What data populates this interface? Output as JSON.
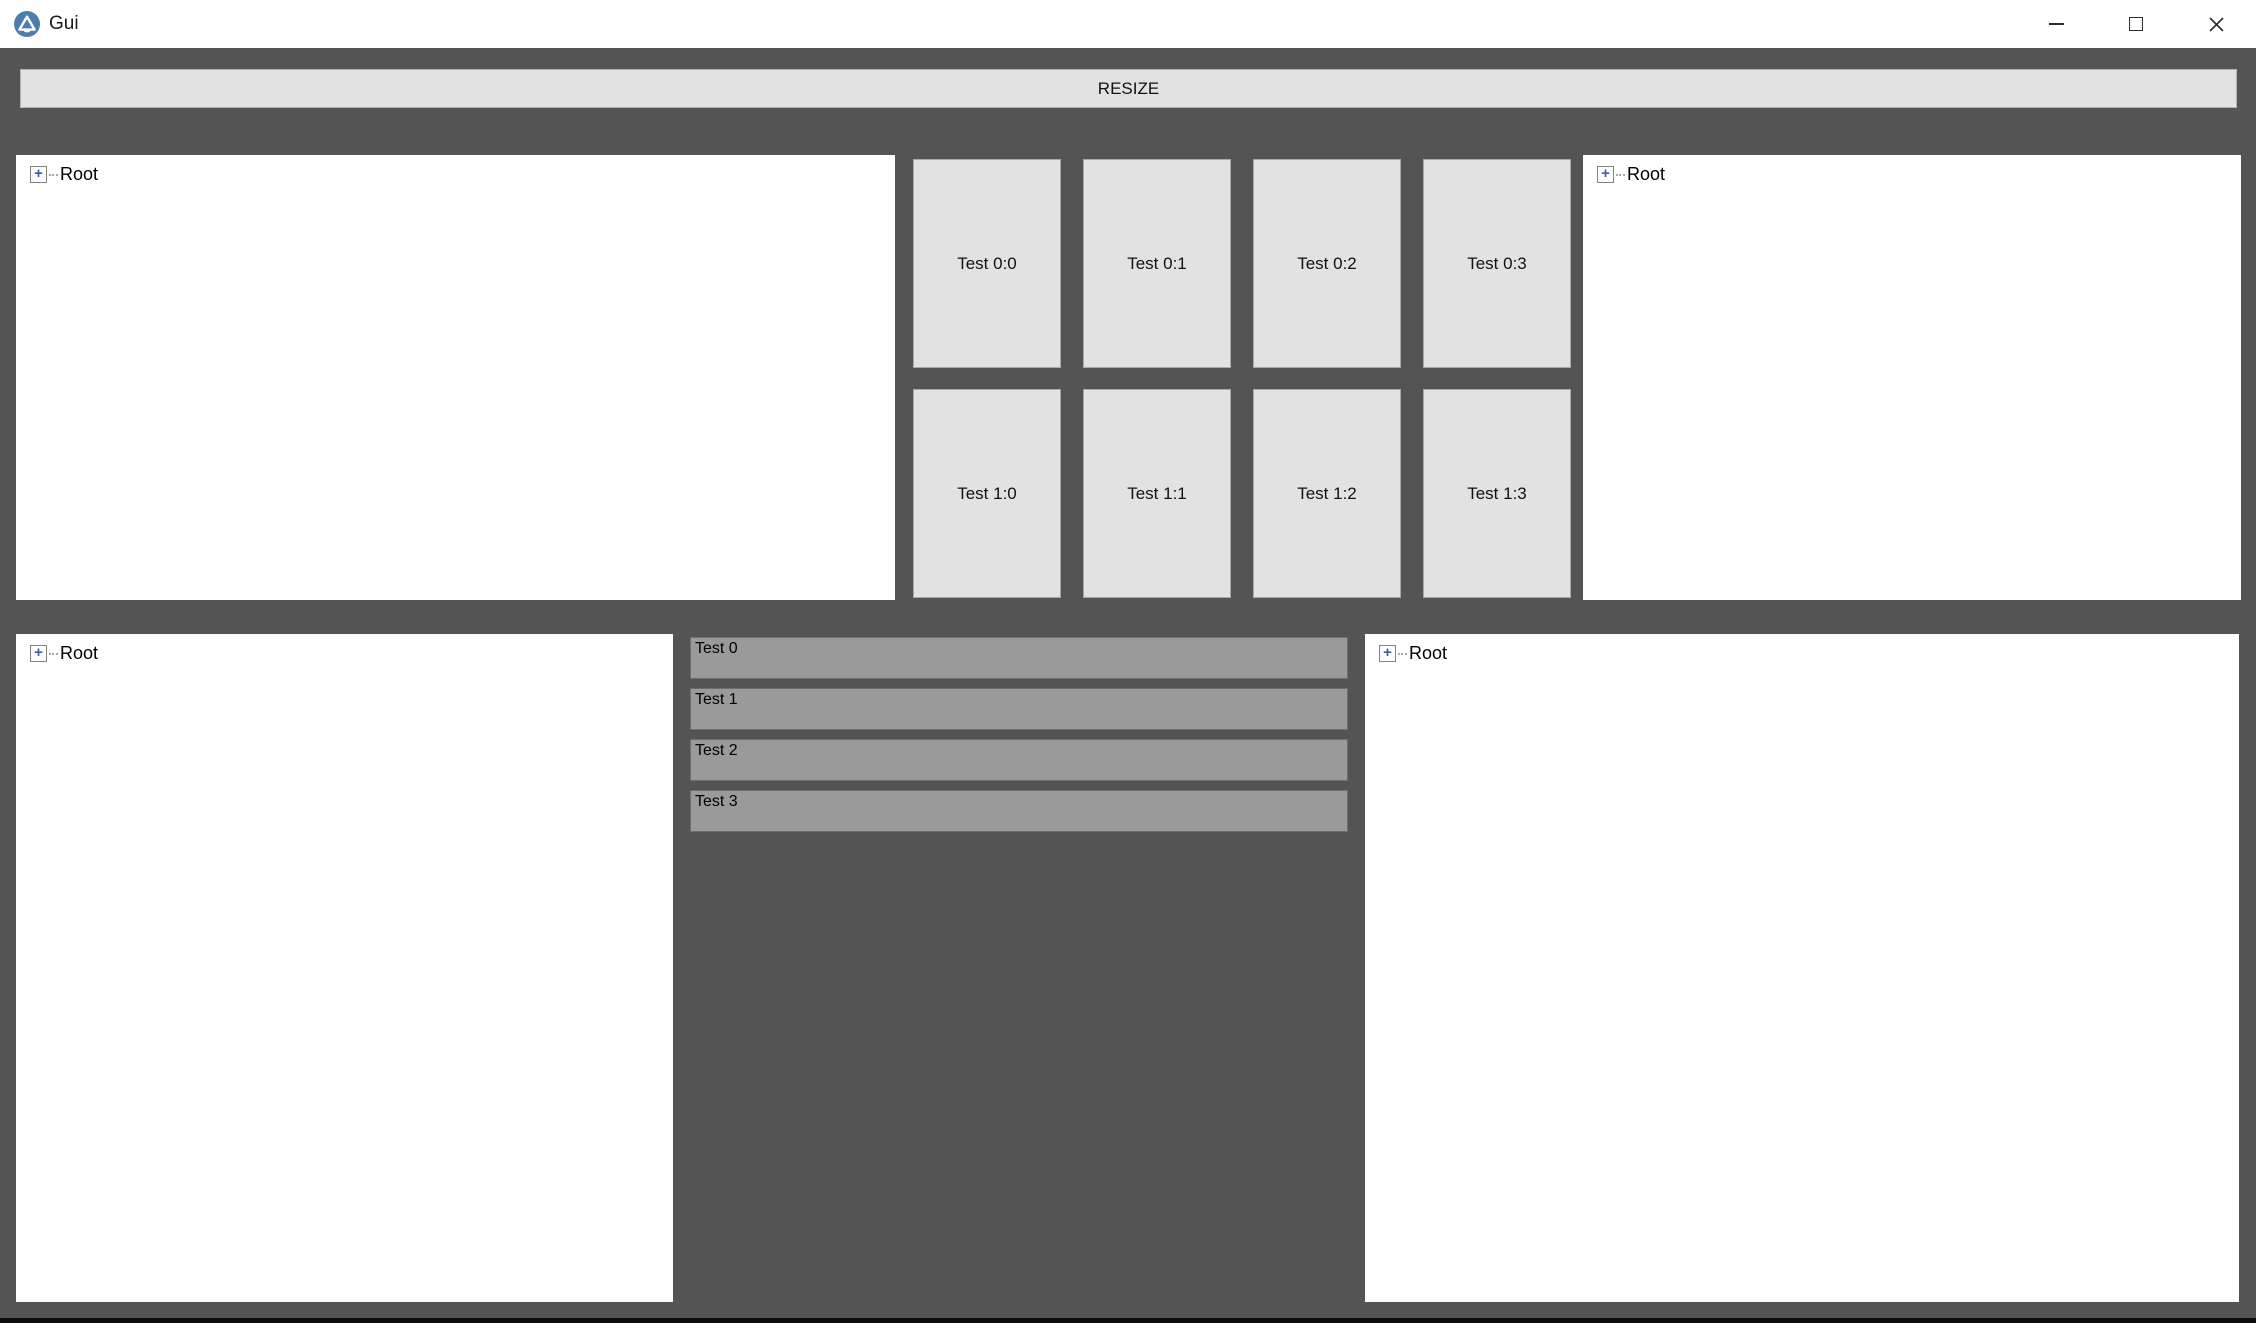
{
  "window": {
    "title": "Gui"
  },
  "titlebar": {
    "icons": {
      "app": "app-logo-icon",
      "minimize": "minimize-icon",
      "maximize": "maximize-icon",
      "close": "close-icon"
    },
    "close_glyph": "✕"
  },
  "toolbar": {
    "resize_label": "RESIZE"
  },
  "trees": {
    "top_left": {
      "root_label": "Root",
      "expand_glyph": "+"
    },
    "top_right": {
      "root_label": "Root",
      "expand_glyph": "+"
    },
    "bottom_left": {
      "root_label": "Root",
      "expand_glyph": "+"
    },
    "bottom_right": {
      "root_label": "Root",
      "expand_glyph": "+"
    }
  },
  "grid": {
    "buttons": [
      {
        "label": "Test 0:0"
      },
      {
        "label": "Test 0:1"
      },
      {
        "label": "Test 0:2"
      },
      {
        "label": "Test 0:3"
      },
      {
        "label": "Test 1:0"
      },
      {
        "label": "Test 1:1"
      },
      {
        "label": "Test 1:2"
      },
      {
        "label": "Test 1:3"
      }
    ]
  },
  "list": {
    "items": [
      {
        "label": "Test 0"
      },
      {
        "label": "Test 1"
      },
      {
        "label": "Test 2"
      },
      {
        "label": "Test 3"
      }
    ]
  },
  "colors": {
    "background": "#545454",
    "titlebar": "#ffffff",
    "button_fill": "#e2e2e2",
    "button_border": "#a9a9a9",
    "list_fill": "#9a9a9a",
    "list_border": "#6e6e6e",
    "app_icon_blue": "#4d7dad",
    "tree_plus_blue": "#3d5cb8",
    "bottom_strip": "#0d0d0d"
  }
}
